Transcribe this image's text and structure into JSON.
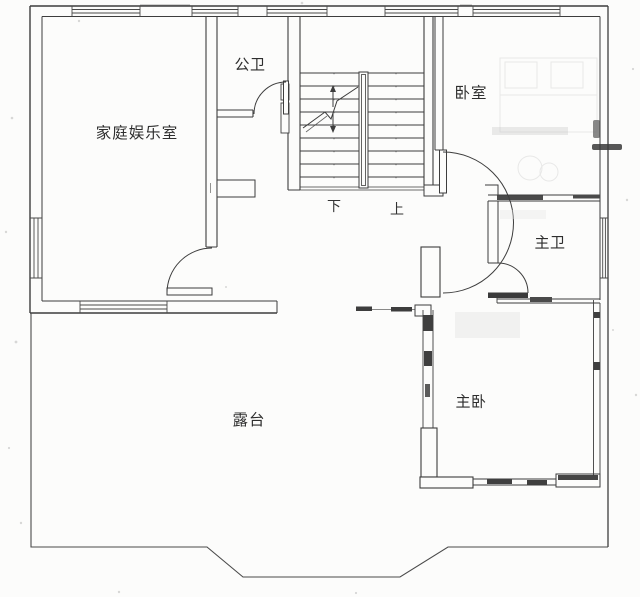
{
  "plan": {
    "rooms": [
      {
        "id": "family-room",
        "label": "家庭娱乐室"
      },
      {
        "id": "public-bath",
        "label": "公卫"
      },
      {
        "id": "bedroom",
        "label": "卧室"
      },
      {
        "id": "master-bath",
        "label": "主卫"
      },
      {
        "id": "master-bedroom",
        "label": "主卧"
      },
      {
        "id": "terrace",
        "label": "露台"
      }
    ],
    "stairs": {
      "down": "下",
      "up": "上"
    },
    "colors": {
      "ink": "#3d3d3d",
      "paper": "#fcfcfb",
      "faint": "#c9c9c9"
    }
  }
}
